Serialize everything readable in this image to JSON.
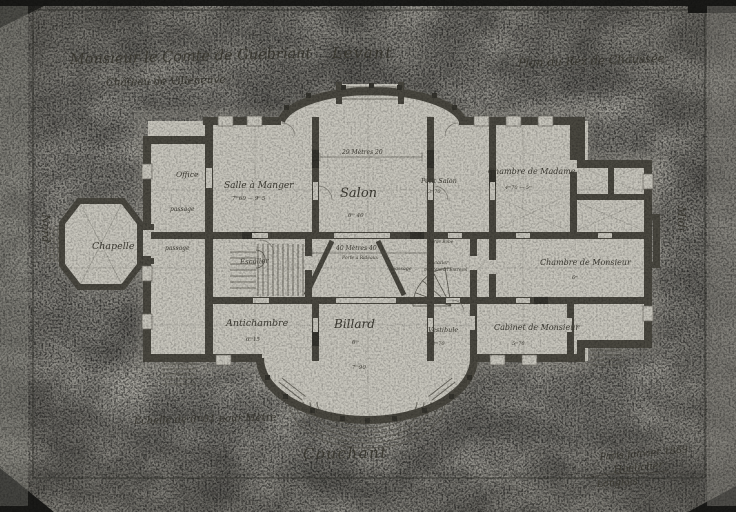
{
  "annotations": {
    "patron_line1": "Monsieur le Comte de Guébriant",
    "patron_line2": "Château de Villeneuve",
    "plan_title": "Plan du Rez de Chaussée",
    "orientation_top": "Levant",
    "orientation_bottom": "Couchant",
    "orientation_left": "Nord",
    "orientation_right": "Midi",
    "scale_note": "Echelle de 0ᵐ01 pour Mètre",
    "date_line": "Paris Janvier 1869",
    "signature1": "Hoelicher",
    "signature2": "Langlois"
  },
  "rooms": {
    "office": {
      "name": "Office"
    },
    "passage_upper": {
      "name": "passage"
    },
    "passage_chapel": {
      "name": "passage"
    },
    "passage_gallery": {
      "name": "passage"
    },
    "salle_a_manger": {
      "name": "Salle à Manger",
      "dim": "7ᵐ60 — 9ᵐ5"
    },
    "salon": {
      "name": "Salon",
      "dim": "6ᵐ 40"
    },
    "petit_salon": {
      "name": "Petit Salon",
      "dim": "3ᵐ70"
    },
    "chambre_madame": {
      "name": "Chambre de Madame",
      "dim": "4ᵐ70 — 5ᵐ"
    },
    "chapelle": {
      "name": "Chapelle"
    },
    "escalier": {
      "name": "Escalier"
    },
    "antichambre": {
      "name": "Antichambre",
      "dim": "6ᵐ15"
    },
    "billard": {
      "name": "Billard",
      "dim": "6ᵐ",
      "dim2": "7ᵐ90"
    },
    "vestibule": {
      "name": "Vestibule",
      "dim": "3ᵐ70"
    },
    "cabinet_monsieur": {
      "name": "Cabinet de Monsieur",
      "dim": "5ᵐ70"
    },
    "chambre_monsieur": {
      "name": "Chambre de Monsieur",
      "dim": "6ᵐ"
    },
    "escalier_entresol": {
      "line1": "Escalier",
      "line2": "montant à l'Entresol"
    },
    "garde_robe": {
      "name": "Garde Robe"
    }
  },
  "dimensions": {
    "salon_width": "29 Mètres 20",
    "gallery_width": "40 Mètres 40",
    "porte_note": "Porte à Rideaux"
  },
  "colors": {
    "paper": "#b3b1a9",
    "plan_paper": "#c8c6bd",
    "wall_ink": "#4a4840",
    "line_ink": "#6e6c64",
    "text_ink": "#3e3c34",
    "photo_edge": "#1a1a18"
  }
}
